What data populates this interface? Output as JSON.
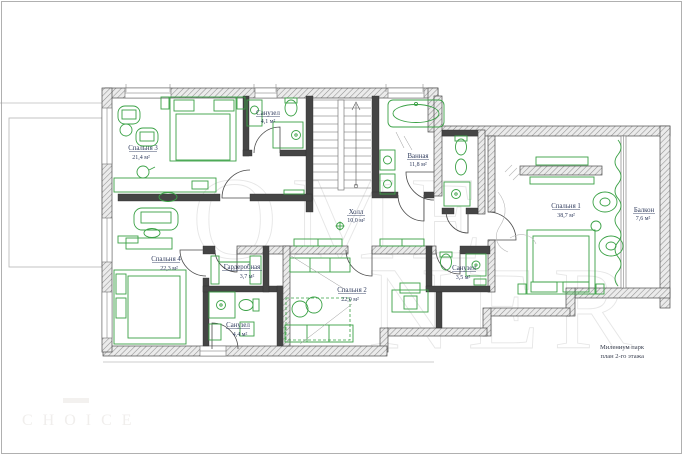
{
  "plan": {
    "rooms": {
      "bedroom3": {
        "name": "Спальня 3",
        "area": "21,4 м²"
      },
      "wc_top": {
        "name": "Санузел",
        "area": "4,1 м²"
      },
      "bath": {
        "name": "Ванная",
        "area": "11,8 м²"
      },
      "hall": {
        "name": "Холл",
        "area": "10,0 м²"
      },
      "bedroom1": {
        "name": "Спальня 1",
        "area": "38,7 м²"
      },
      "balcony": {
        "name": "Балкон",
        "area": "7,6 м²"
      },
      "bedroom4": {
        "name": "Спальня 4",
        "area": "22,3 м²"
      },
      "wardrobe": {
        "name": "Гардеробная",
        "area": "3,7 м²"
      },
      "wc_bl": {
        "name": "Санузел",
        "area": "4,4 м²"
      },
      "bedroom2": {
        "name": "Спальня 2",
        "area": "22,0 м²"
      },
      "wc_br": {
        "name": "Санузел",
        "area": "3,5 м²"
      }
    },
    "title_block": {
      "project": "Милениум парк",
      "sheet": "план 2-го этажа"
    },
    "watermarks": {
      "center_top": "OME",
      "center_bottom": "NER",
      "corner": "CHOICE"
    },
    "colors": {
      "furniture_green": "#3aa145",
      "wall_gray": "#4c4c4c",
      "label_navy": "#2e3a5c"
    }
  }
}
